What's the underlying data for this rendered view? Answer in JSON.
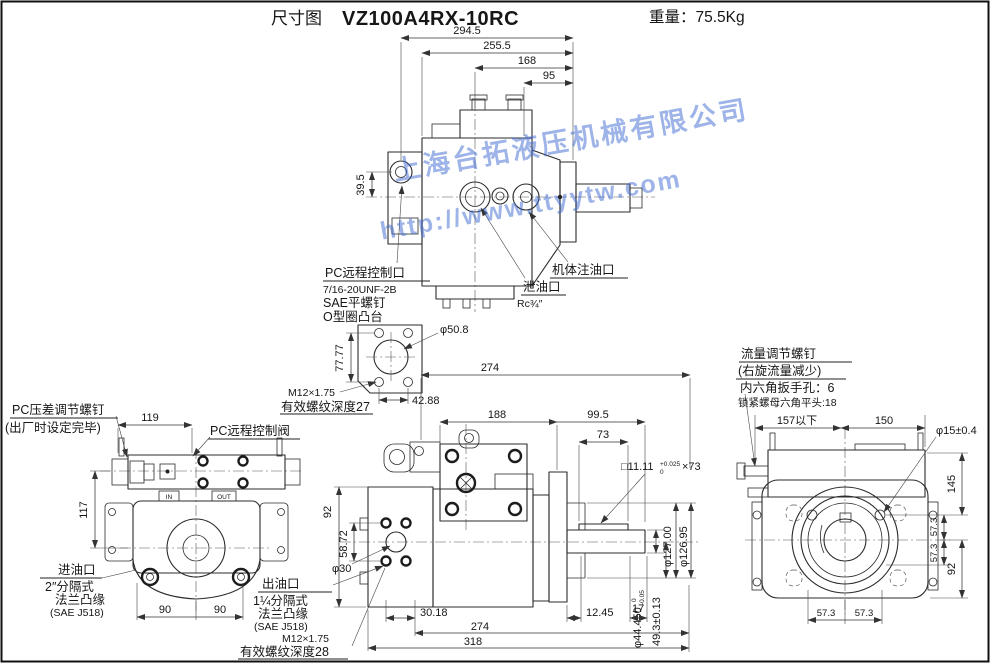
{
  "title": {
    "drawing_label": "尺寸图",
    "model": "VZ100A4RX-10RC",
    "weight": "重量：75.5Kg"
  },
  "watermark": {
    "line1": "上海台拓液压机械有限公司",
    "line2": "http://www.ttyytw.com"
  },
  "top_view": {
    "d294": "294.5",
    "d255": "255.5",
    "d168": "168",
    "d95": "95",
    "d39": "39.5",
    "port_label": "PC远程控制口",
    "port_thread": "7/16-20UNF-2B",
    "port_screw": "SAE平螺钉",
    "port_boss": "O型圈凸台",
    "drain_label": "泄油口",
    "drain_size": "Rc¾″",
    "fill_label": "机体注油口"
  },
  "flange_detail": {
    "phi": "φ50.8",
    "h": "77.77",
    "w": "42.88",
    "thread": "M12×1.75",
    "depth": "有效螺纹深度27"
  },
  "left_view": {
    "d119": "119",
    "d117": "117",
    "d90l": "90",
    "d90r": "90",
    "in": "IN",
    "out": "OUT",
    "adj_line1": "PC压差调节螺钉",
    "adj_line2": "(出厂时设定完毕)",
    "valve_label": "PC远程控制阀",
    "inlet_line1": "进油口",
    "inlet_line2": "2″分隔式",
    "inlet_line3": "法兰凸缘",
    "inlet_line4": "(SAE J518)"
  },
  "front_view": {
    "d274_top": "274",
    "d188": "188",
    "d99": "99.5",
    "d73": "73",
    "d92": "92",
    "d58": "58.72",
    "phi30": "φ30",
    "key_base": "□11.11",
    "key_tol_top": "+0.025",
    "key_tol_bot": "0",
    "key_len": "×73",
    "phi127": "φ127.00",
    "phi126": "φ126.95",
    "shaft_base": "φ44.450",
    "shaft_tol_top": "0",
    "shaft_tol_bot": "-0.05",
    "d49": "49.3±0.13",
    "d30": "30.18",
    "d17": "17",
    "d12": "12.45",
    "d274_bot": "274",
    "d318": "318",
    "outlet_line1": "出油口",
    "outlet_line2": "1¼分隔式",
    "outlet_line3": "法兰凸缘",
    "outlet_line4": "(SAE J518)",
    "outlet_line5": "M12×1.75",
    "outlet_line6": "有效螺纹深度28"
  },
  "right_view": {
    "d157": "157以下",
    "d150": "150",
    "phi15": "φ15±0.4",
    "d145": "145",
    "d57_top": "57.3",
    "d57_bot": "57.3",
    "d92": "92",
    "d57_bl": "57.3",
    "d57_br": "57.3",
    "flow_line1": "流量调节螺钉",
    "flow_line2": "(右旋流量减少)",
    "flow_line3": "内六角扳手孔：6",
    "flow_line4": "锁紧螺母六角平头:18"
  }
}
